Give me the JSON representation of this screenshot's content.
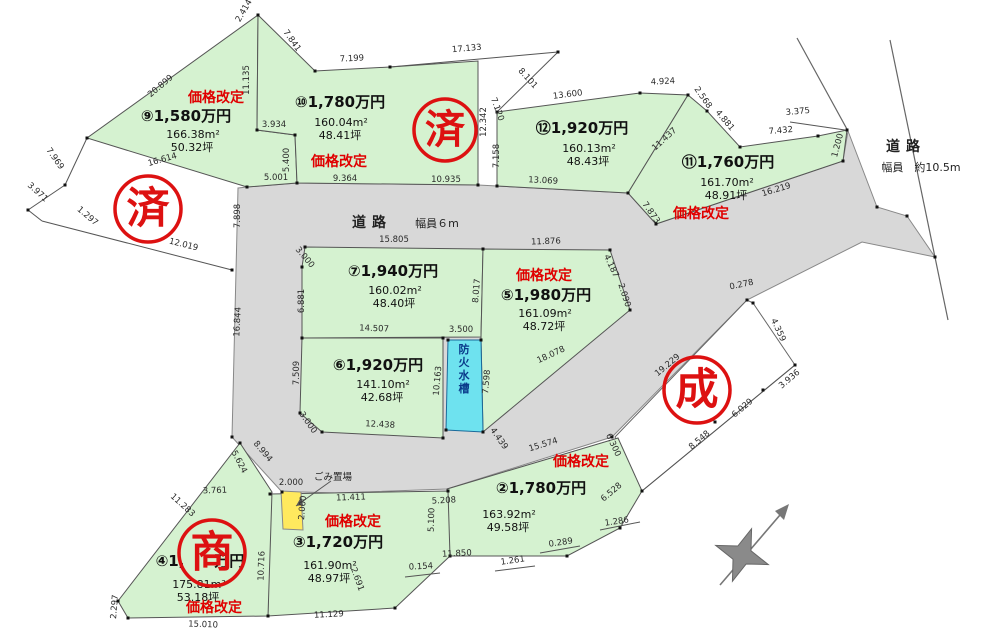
{
  "map": {
    "type": "land-subdivision-plot-map",
    "colors": {
      "plot_green": "#d5f2d0",
      "road_gray": "#d8d8d8",
      "tank_cyan": "#6ee2ef",
      "stamp_red": "#dd1111",
      "badge_red": "#e00000",
      "gomi_yellow": "#ffe95e"
    },
    "roads": [
      {
        "name": "main-road",
        "label": "道路",
        "width_label": "幅員６m",
        "label_x": 372,
        "label_y": 227,
        "width_x": 437,
        "width_y": 227
      },
      {
        "name": "right-road",
        "label": "道路",
        "width_label": "幅員　約10.5m",
        "label_x": 906,
        "label_y": 151,
        "width_x": 921,
        "width_y": 171
      }
    ],
    "plots": [
      {
        "number": "⑨",
        "price": "1,580万円",
        "area_m2": "166.38m²",
        "area_tsubo": "50.32坪",
        "badge": "価格改定",
        "px": 186,
        "py": 121,
        "ax": 193,
        "ay": 138,
        "bx": 216,
        "by": 102
      },
      {
        "number": "⑩",
        "price": "1,780万円",
        "area_m2": "160.04m²",
        "area_tsubo": "48.41坪",
        "badge": "価格改定",
        "px": 340,
        "py": 107,
        "ax": 341,
        "ay": 126,
        "bx": 339,
        "by": 166
      },
      {
        "number": "⑫",
        "price": "1,920万円",
        "area_m2": "160.13m²",
        "area_tsubo": "48.43坪",
        "badge": null,
        "px": 582,
        "py": 133,
        "ax": 589,
        "ay": 152
      },
      {
        "number": "⑪",
        "price": "1,760万円",
        "area_m2": "161.70m²",
        "area_tsubo": "48.91坪",
        "badge": "価格改定",
        "px": 728,
        "py": 167,
        "ax": 727,
        "ay": 186,
        "bx": 701,
        "by": 218
      },
      {
        "number": "⑦",
        "price": "1,940万円",
        "area_m2": "160.02m²",
        "area_tsubo": "48.40坪",
        "badge": null,
        "px": 393,
        "py": 276,
        "ax": 395,
        "ay": 294
      },
      {
        "number": "⑤",
        "price": "1,980万円",
        "area_m2": "161.09m²",
        "area_tsubo": "48.72坪",
        "badge": "価格改定",
        "px": 546,
        "py": 300,
        "ax": 545,
        "ay": 317,
        "bx": 544,
        "by": 280
      },
      {
        "number": "⑥",
        "price": "1,920万円",
        "area_m2": "141.10m²",
        "area_tsubo": "42.68坪",
        "badge": null,
        "px": 378,
        "py": 370,
        "ax": 383,
        "ay": 388
      },
      {
        "number": "②",
        "price": "1,780万円",
        "area_m2": "163.92m²",
        "area_tsubo": "49.58坪",
        "badge": "価格改定",
        "px": 541,
        "py": 493,
        "ax": 509,
        "ay": 518,
        "bx": 581,
        "by": 466
      },
      {
        "number": "③",
        "price": "1,720万円",
        "area_m2": "161.90m²",
        "area_tsubo": "48.97坪",
        "badge": "価格改定",
        "px": 338,
        "py": 547,
        "ax": 330,
        "ay": 569,
        "bx": 353,
        "by": 526
      },
      {
        "number": "④",
        "price": "1,　　万円",
        "price_note": "digits hidden behind 商 stamp",
        "area_m2": "175.81m²",
        "area_tsubo": "53.18坪",
        "badge": "価格改定",
        "px": 200,
        "py": 566,
        "ax": 199,
        "ay": 588,
        "bx": 214,
        "by": 612
      }
    ],
    "stamps": [
      {
        "text": "済",
        "x": 148,
        "y": 209,
        "r": 33
      },
      {
        "text": "済",
        "x": 445,
        "y": 130,
        "r": 31
      },
      {
        "text": "成",
        "x": 697,
        "y": 390,
        "r": 33
      },
      {
        "text": "商",
        "x": 212,
        "y": 553,
        "r": 33
      }
    ],
    "facilities": [
      {
        "name": "防火水槽",
        "x": 464,
        "y": 353,
        "vertical": true
      },
      {
        "name": "ごみ置場",
        "x": 333,
        "y": 480,
        "vertical": false
      }
    ],
    "dimensions": [
      {
        "t": "2.414",
        "x": 246,
        "y": 12,
        "r": -60
      },
      {
        "t": "7.841",
        "x": 290,
        "y": 42,
        "r": 55
      },
      {
        "t": "7.199",
        "x": 352,
        "y": 61,
        "r": -3
      },
      {
        "t": "17.133",
        "x": 467,
        "y": 51,
        "r": -5
      },
      {
        "t": "8.101",
        "x": 526,
        "y": 80,
        "r": 48
      },
      {
        "t": "11.135",
        "x": 249,
        "y": 80,
        "r": -90
      },
      {
        "t": "20.899",
        "x": 162,
        "y": 88,
        "r": -40
      },
      {
        "t": "3.934",
        "x": 274,
        "y": 127,
        "r": 0
      },
      {
        "t": "5.400",
        "x": 289,
        "y": 160,
        "r": -90
      },
      {
        "t": "12.342",
        "x": 486,
        "y": 122,
        "r": -90
      },
      {
        "t": "7.120",
        "x": 495,
        "y": 110,
        "r": 70
      },
      {
        "t": "7.158",
        "x": 499,
        "y": 156,
        "r": -90
      },
      {
        "t": "13.600",
        "x": 568,
        "y": 97,
        "r": -7
      },
      {
        "t": "4.924",
        "x": 663,
        "y": 84,
        "r": -3
      },
      {
        "t": "2.568",
        "x": 701,
        "y": 99,
        "r": 55
      },
      {
        "t": "4.881",
        "x": 723,
        "y": 122,
        "r": 50
      },
      {
        "t": "11.437",
        "x": 666,
        "y": 141,
        "r": -42
      },
      {
        "t": "3.375",
        "x": 798,
        "y": 114,
        "r": -5
      },
      {
        "t": "7.432",
        "x": 781,
        "y": 133,
        "r": -5
      },
      {
        "t": "1.200",
        "x": 840,
        "y": 146,
        "r": -75
      },
      {
        "t": "13.069",
        "x": 543,
        "y": 183,
        "r": 3
      },
      {
        "t": "16.219",
        "x": 777,
        "y": 192,
        "r": -17
      },
      {
        "t": "7.873",
        "x": 649,
        "y": 214,
        "r": 55
      },
      {
        "t": "16.614",
        "x": 163,
        "y": 162,
        "r": -16
      },
      {
        "t": "7.969",
        "x": 53,
        "y": 160,
        "r": 55
      },
      {
        "t": "3.971",
        "x": 36,
        "y": 194,
        "r": 42
      },
      {
        "t": "1.297",
        "x": 86,
        "y": 218,
        "r": 40
      },
      {
        "t": "12.019",
        "x": 183,
        "y": 247,
        "r": 14
      },
      {
        "t": "5.001",
        "x": 276,
        "y": 180,
        "r": 0
      },
      {
        "t": "9.364",
        "x": 345,
        "y": 181,
        "r": 0
      },
      {
        "t": "10.935",
        "x": 446,
        "y": 182,
        "r": 0
      },
      {
        "t": "7.898",
        "x": 240,
        "y": 216,
        "r": -90
      },
      {
        "t": "16.844",
        "x": 240,
        "y": 322,
        "r": -87
      },
      {
        "t": "3.000",
        "x": 303,
        "y": 259,
        "r": 50
      },
      {
        "t": "15.805",
        "x": 394,
        "y": 242,
        "r": 0
      },
      {
        "t": "11.876",
        "x": 546,
        "y": 244,
        "r": -2
      },
      {
        "t": "6.881",
        "x": 304,
        "y": 301,
        "r": -90
      },
      {
        "t": "8.017",
        "x": 479,
        "y": 291,
        "r": -85
      },
      {
        "t": "14.507",
        "x": 374,
        "y": 331,
        "r": 2
      },
      {
        "t": "3.500",
        "x": 461,
        "y": 332,
        "r": 0
      },
      {
        "t": "4.187",
        "x": 609,
        "y": 267,
        "r": 65
      },
      {
        "t": "2.090",
        "x": 622,
        "y": 296,
        "r": 72
      },
      {
        "t": "18.078",
        "x": 552,
        "y": 357,
        "r": -25
      },
      {
        "t": "7.509",
        "x": 299,
        "y": 373,
        "r": -90
      },
      {
        "t": "3.000",
        "x": 306,
        "y": 424,
        "r": 55
      },
      {
        "t": "12.438",
        "x": 380,
        "y": 427,
        "r": 3
      },
      {
        "t": "10.163",
        "x": 440,
        "y": 381,
        "r": -85
      },
      {
        "t": "7.598",
        "x": 489,
        "y": 382,
        "r": -85
      },
      {
        "t": "4.439",
        "x": 497,
        "y": 440,
        "r": 55
      },
      {
        "t": "0.278",
        "x": 742,
        "y": 287,
        "r": -12
      },
      {
        "t": "4.359",
        "x": 776,
        "y": 331,
        "r": 65
      },
      {
        "t": "19.229",
        "x": 669,
        "y": 367,
        "r": -40
      },
      {
        "t": "3.936",
        "x": 791,
        "y": 381,
        "r": -40
      },
      {
        "t": "6.029",
        "x": 744,
        "y": 410,
        "r": -40
      },
      {
        "t": "8.548",
        "x": 701,
        "y": 442,
        "r": -40
      },
      {
        "t": "6.528",
        "x": 613,
        "y": 494,
        "r": -40
      },
      {
        "t": "1.286",
        "x": 617,
        "y": 524,
        "r": -8
      },
      {
        "t": "0.289",
        "x": 561,
        "y": 545,
        "r": -8
      },
      {
        "t": "1.261",
        "x": 513,
        "y": 563,
        "r": -8
      },
      {
        "t": "15.574",
        "x": 544,
        "y": 447,
        "r": -17
      },
      {
        "t": "6.300",
        "x": 611,
        "y": 446,
        "r": 65
      },
      {
        "t": "5.208",
        "x": 444,
        "y": 503,
        "r": -3
      },
      {
        "t": "11.850",
        "x": 457,
        "y": 556,
        "r": -3
      },
      {
        "t": "0.154",
        "x": 421,
        "y": 569,
        "r": -3
      },
      {
        "t": "5.100",
        "x": 434,
        "y": 520,
        "r": -88
      },
      {
        "t": "2.691",
        "x": 355,
        "y": 580,
        "r": 70
      },
      {
        "t": "11.283",
        "x": 181,
        "y": 507,
        "r": 42
      },
      {
        "t": "10.716",
        "x": 264,
        "y": 566,
        "r": -88
      },
      {
        "t": "2.297",
        "x": 117,
        "y": 607,
        "r": -85
      },
      {
        "t": "15.010",
        "x": 203,
        "y": 627,
        "r": 2
      },
      {
        "t": "11.129",
        "x": 329,
        "y": 617,
        "r": -3
      },
      {
        "t": "3.761",
        "x": 215,
        "y": 493,
        "r": -2
      },
      {
        "t": "2.000",
        "x": 291,
        "y": 485,
        "r": 0
      },
      {
        "t": "2.000",
        "x": 305,
        "y": 508,
        "r": -85
      },
      {
        "t": "5.624",
        "x": 237,
        "y": 463,
        "r": 62
      },
      {
        "t": "8.994",
        "x": 261,
        "y": 453,
        "r": 50
      },
      {
        "t": "11.411",
        "x": 351,
        "y": 500,
        "r": -2
      }
    ]
  }
}
